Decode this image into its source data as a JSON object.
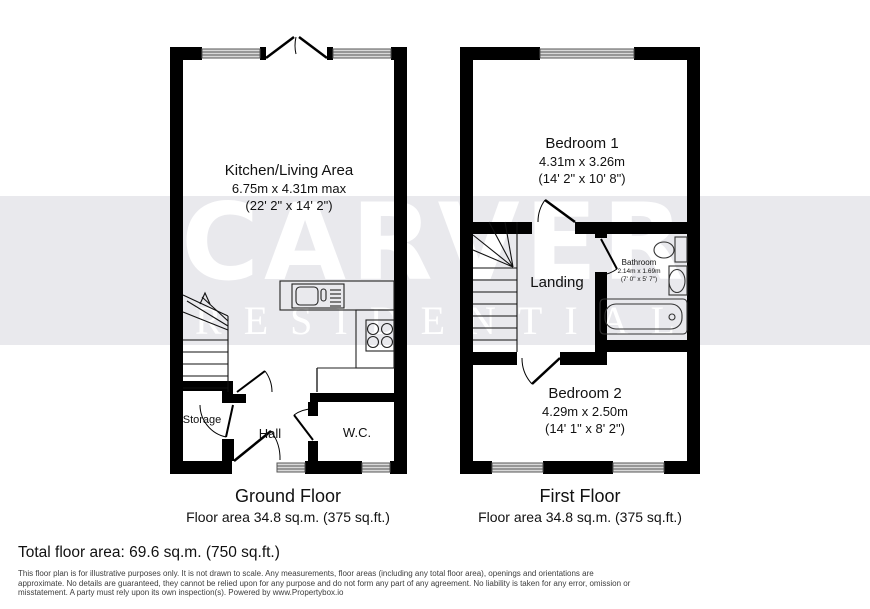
{
  "watermark": {
    "line1": "CARVER",
    "line2": "RESIDENTIAL",
    "band_color": "#e9e9ed",
    "text_color": "#ffffff"
  },
  "colors": {
    "walls": "#000000",
    "window_fill": "#d9d9d9"
  },
  "ground_floor": {
    "title": "Ground Floor",
    "area": "Floor area 34.8 sq.m. (375 sq.ft.)",
    "rooms": {
      "kitchen_living": {
        "name": "Kitchen/Living Area",
        "dims_metric": "6.75m x 4.31m max",
        "dims_imperial": "(22' 2\" x 14' 2\")"
      },
      "storage": {
        "name": "Storage"
      },
      "hall": {
        "name": "Hall"
      },
      "wc": {
        "name": "W.C."
      }
    }
  },
  "first_floor": {
    "title": "First Floor",
    "area": "Floor area 34.8 sq.m. (375 sq.ft.)",
    "rooms": {
      "bedroom1": {
        "name": "Bedroom 1",
        "dims_metric": "4.31m x 3.26m",
        "dims_imperial": "(14' 2\" x 10' 8\")"
      },
      "landing": {
        "name": "Landing"
      },
      "bathroom": {
        "name": "Bathroom",
        "dims_metric": "2.14m x 1.69m",
        "dims_imperial": "(7' 0\" x 5' 7\")"
      },
      "bedroom2": {
        "name": "Bedroom 2",
        "dims_metric": "4.29m x 2.50m",
        "dims_imperial": "(14' 1\" x 8' 2\")"
      }
    }
  },
  "footer": {
    "total_area": "Total floor area: 69.6 sq.m. (750 sq.ft.)",
    "disclaimer_lines": [
      "This floor plan is for illustrative purposes only. It is not drawn to scale. Any measurements, floor areas (including any total floor area), openings and orientations are",
      "approximate. No details are guaranteed, they cannot be relied upon for any purpose and do not form any part of any agreement. No liability is taken for any error, omission or",
      "misstatement. A party must rely upon its own inspection(s). Powered by www.Propertybox.io"
    ]
  }
}
